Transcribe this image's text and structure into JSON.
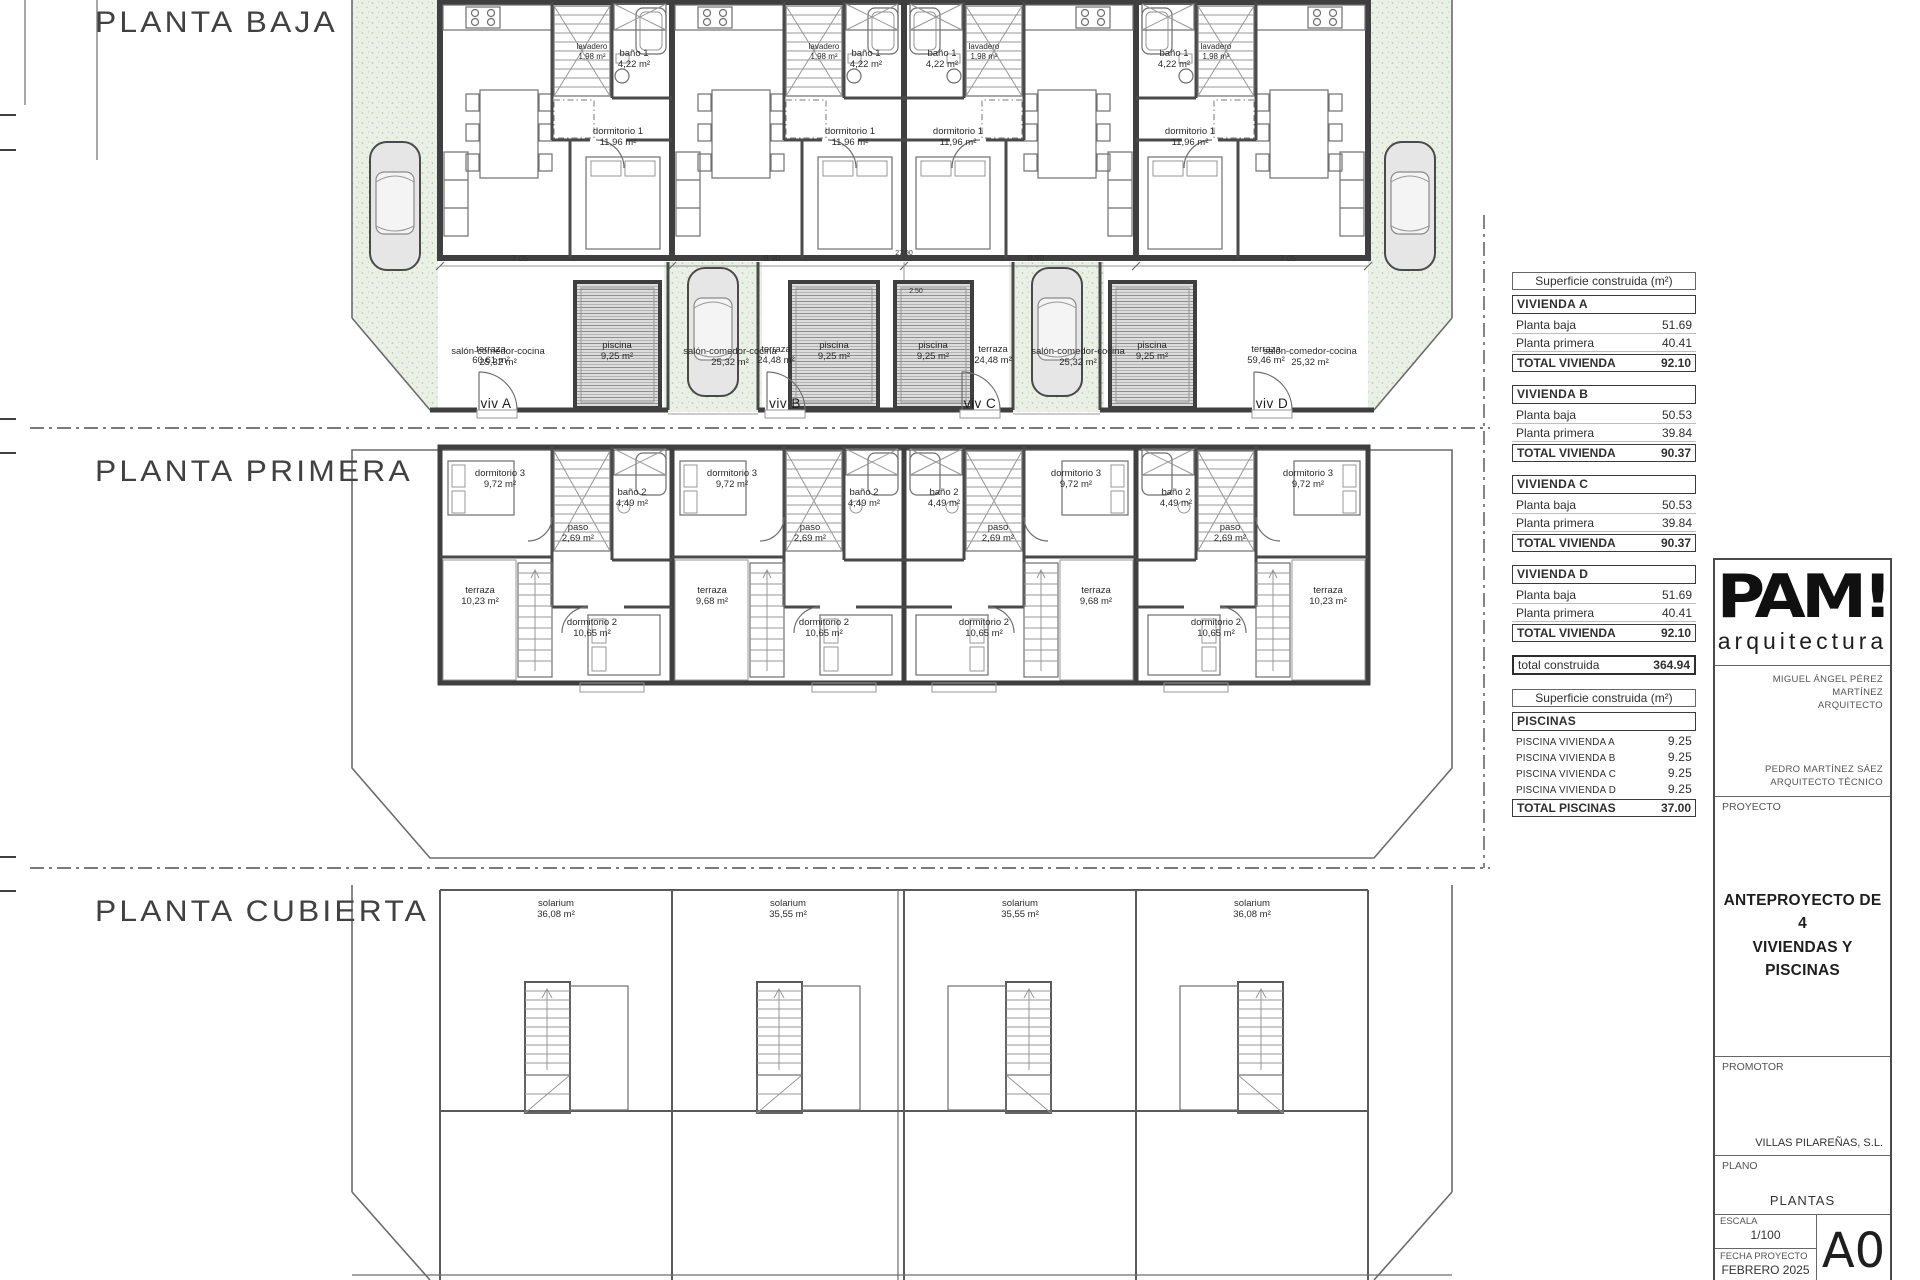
{
  "plans": {
    "baja": {
      "title": "PLANTA BAJA"
    },
    "primera": {
      "title": "PLANTA PRIMERA"
    },
    "cubierta": {
      "title": "PLANTA CUBIERTA"
    }
  },
  "rooms": {
    "salon": {
      "name": "salón-comedor-cocina",
      "area": "25,32 m²"
    },
    "dorm1": {
      "name": "dormitorio 1",
      "area": "11,96 m²"
    },
    "bano1": {
      "name": "baño 1",
      "area": "4,22 m²"
    },
    "lavadero": {
      "name": "lavadero",
      "area": "1,98 m²"
    },
    "dorm3": {
      "name": "dormitorio 3",
      "area": "9,72 m²"
    },
    "bano2": {
      "name": "baño 2",
      "area": "4,49 m²"
    },
    "paso": {
      "name": "paso",
      "area": "2,69 m²"
    },
    "dorm2": {
      "name": "dormitorio 2",
      "area": "10,65 m²"
    },
    "terraza_ext": {
      "name": "terraza",
      "area": "10,23 m²"
    },
    "terraza_int": {
      "name": "terraza",
      "area": "9,68 m²"
    },
    "solarium_ext": {
      "name": "solarium",
      "area": "36,08 m²"
    },
    "solarium_int": {
      "name": "solarium",
      "area": "35,55 m²"
    },
    "piscina": {
      "name": "piscina",
      "area": "9,25 m²"
    },
    "terraza_a": {
      "name": "terraza",
      "area": "60,61 m²"
    },
    "terraza_b": {
      "name": "terraza",
      "area": "24,48 m²"
    },
    "terraza_c": {
      "name": "terraza",
      "area": "24,48 m²"
    },
    "terraza_d": {
      "name": "terraza",
      "area": "59,46 m²"
    }
  },
  "viv": {
    "a": "viv A",
    "b": "viv B",
    "c": "viv C",
    "d": "viv D"
  },
  "dims": {
    "d1": "7.05",
    "d2": "8.90",
    "center": "27.90",
    "d4": "8.90",
    "d5": "7.05",
    "pool": "2.50"
  },
  "summary": {
    "header": "Superficie construida (m²)",
    "row_labels": {
      "baja": "Planta baja",
      "primera": "Planta primera",
      "total": "TOTAL VIVIENDA"
    },
    "viviendas": [
      {
        "name": "VIVIENDA A",
        "baja": "51.69",
        "primera": "40.41",
        "total": "92.10"
      },
      {
        "name": "VIVIENDA B",
        "baja": "50.53",
        "primera": "39.84",
        "total": "90.37"
      },
      {
        "name": "VIVIENDA C",
        "baja": "50.53",
        "primera": "39.84",
        "total": "90.37"
      },
      {
        "name": "VIVIENDA D",
        "baja": "51.69",
        "primera": "40.41",
        "total": "92.10"
      }
    ],
    "total_label": "total construida",
    "total_value": "364.94"
  },
  "pools_table": {
    "header": "Superficie construida (m²)",
    "title": "PISCINAS",
    "rows": [
      {
        "label": "PISCINA VIVIENDA A",
        "value": "9.25"
      },
      {
        "label": "PISCINA VIVIENDA B",
        "value": "9.25"
      },
      {
        "label": "PISCINA VIVIENDA C",
        "value": "9.25"
      },
      {
        "label": "PISCINA VIVIENDA D",
        "value": "9.25"
      }
    ],
    "total_label": "TOTAL PISCINAS",
    "total_value": "37.00"
  },
  "titleblock": {
    "logo": "PAM!",
    "logo_sub": "arquitectura",
    "architect_name": "MIGUEL ÁNGEL PÉREZ MARTÍNEZ",
    "architect_role": "ARQUITECTO",
    "tech_name": "PEDRO MARTÍNEZ SÁEZ",
    "tech_role": "ARQUITECTO TÉCNICO",
    "proyecto_label": "PROYECTO",
    "proyecto_line1": "ANTEPROYECTO DE  4",
    "proyecto_line2": "VIVIENDAS Y PISCINAS",
    "promotor_label": "PROMOTOR",
    "promotor": "VILLAS PILAREÑAS, S.L.",
    "plano_label": "PLANO",
    "plano": "PLANTAS",
    "escala_label": "ESCALA",
    "escala": "1/100",
    "fecha_label": "FECHA PROYECTO",
    "fecha": "FEBRERO 2025",
    "sheet": "A0"
  }
}
